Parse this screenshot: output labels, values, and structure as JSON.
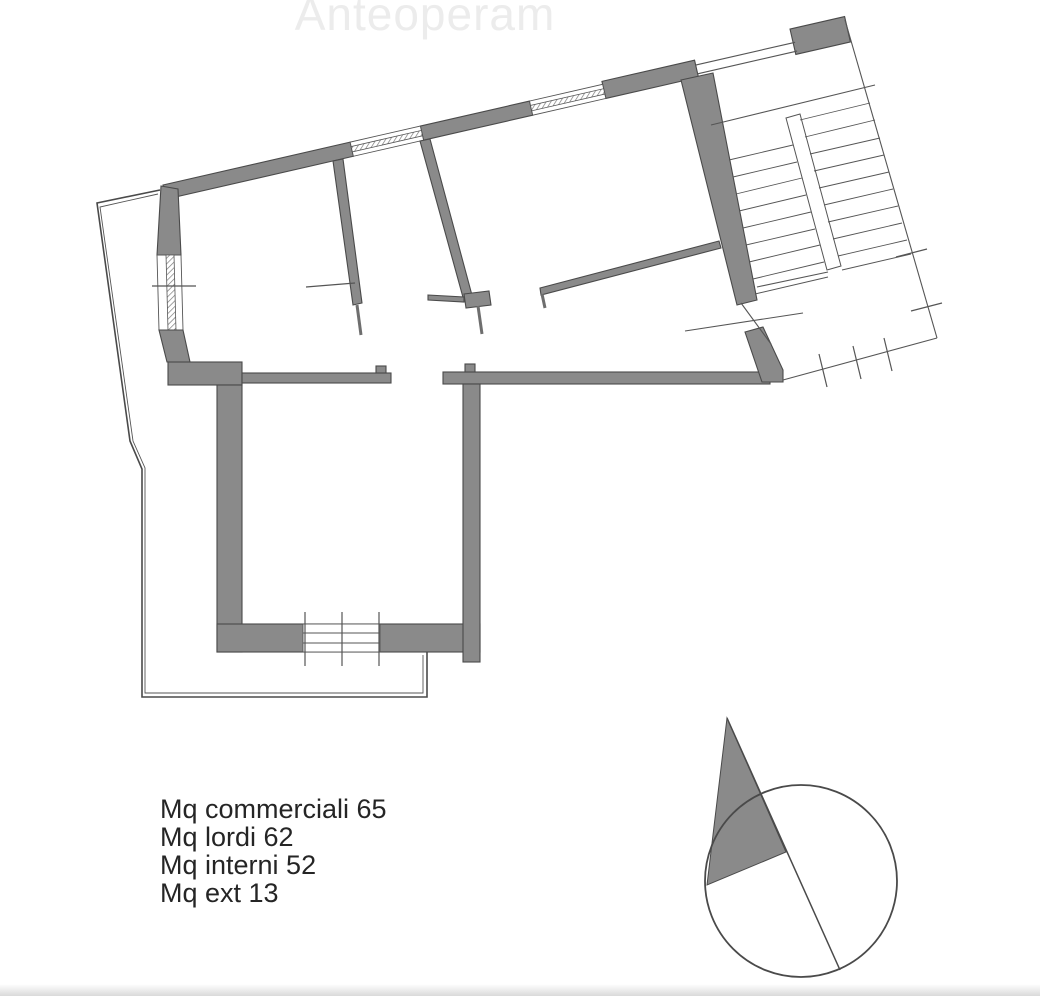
{
  "watermark": {
    "text": "Anteoperam"
  },
  "area_summary": {
    "lines": [
      {
        "text": "Mq commerciali 65",
        "label": "Mq commerciali",
        "value": 65
      },
      {
        "text": "Mq lordi 62",
        "label": "Mq lordi",
        "value": 62
      },
      {
        "text": "Mq interni 52",
        "label": "Mq interni",
        "value": 52
      },
      {
        "text": "Mq ext 13",
        "label": "Mq ext",
        "value": 13
      }
    ]
  },
  "floor_plan": {
    "kind": "apartment floor plan with stairwell, lower wing room, exterior terrace and north arrow",
    "colors": {
      "wall_fill": "#8a8a8a",
      "outline": "#4a4a4a",
      "thin_line": "#555555",
      "watermark": "#ececec",
      "text": "#252525",
      "background": "#ffffff"
    }
  }
}
